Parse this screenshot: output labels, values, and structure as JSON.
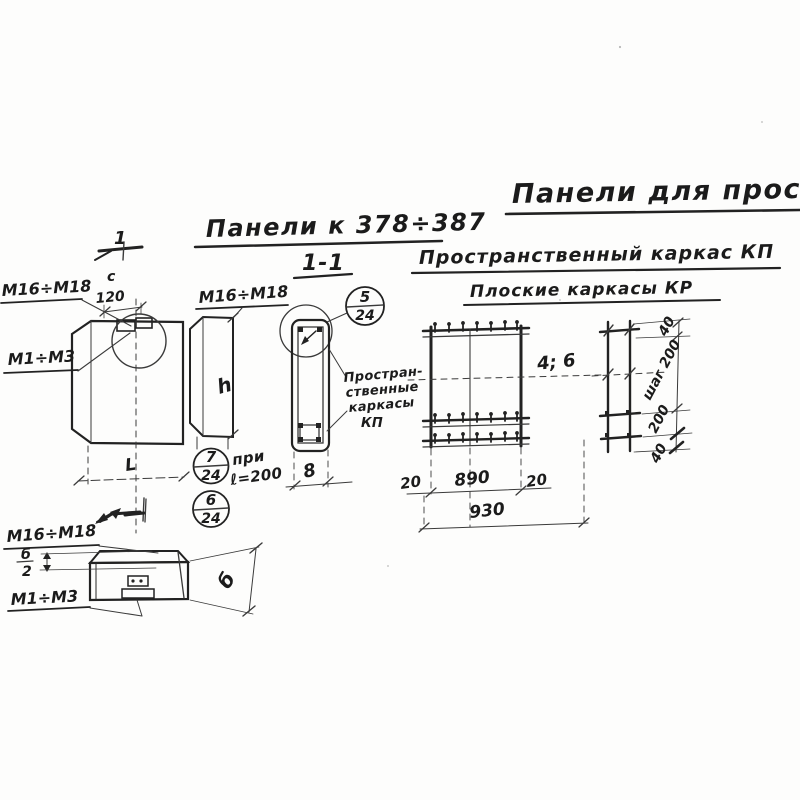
{
  "titles": {
    "top_right": "Панели для прост",
    "panels_range": "Панели к 378÷387",
    "section_mark": "1-1",
    "spatial_frame": "Пространственный каркас КП",
    "flat_frames": "Плоские каркасы КР"
  },
  "front_view": {
    "bolt_top_label": "М16÷М18",
    "bolt_left_label": "М1÷М3",
    "dim_c": "с",
    "dim_120": "120",
    "dim_length": "L",
    "section_cut_number": "1"
  },
  "side_view": {
    "bolt_label": "М16÷М18",
    "dim_height": "h"
  },
  "section_view": {
    "dim_width": "8",
    "note_lines": [
      "Простран-",
      "ственные",
      "каркасы",
      "КП"
    ]
  },
  "callouts": {
    "c5_num": "5",
    "c5_den": "24",
    "c6_num": "6",
    "c6_den": "24",
    "c7_num": "7",
    "c7_den": "24",
    "c7_note_line1": "при",
    "c7_note_line2": "ℓ=200"
  },
  "kp_plan": {
    "count_label": "4; 6",
    "dim_left": "20",
    "dim_mid": "890",
    "dim_right": "20",
    "dim_total": "930"
  },
  "kr_frame": {
    "dim_top": "40",
    "dim_step": "шаг 200",
    "dim_mid": "200",
    "dim_bottom": "40"
  },
  "bottom_view": {
    "bolt_top_label": "М16÷М18",
    "bolt_bottom_label": "М1÷М3",
    "half_dim_num": "б",
    "half_dim_den": "2",
    "dim_thickness": "б"
  }
}
